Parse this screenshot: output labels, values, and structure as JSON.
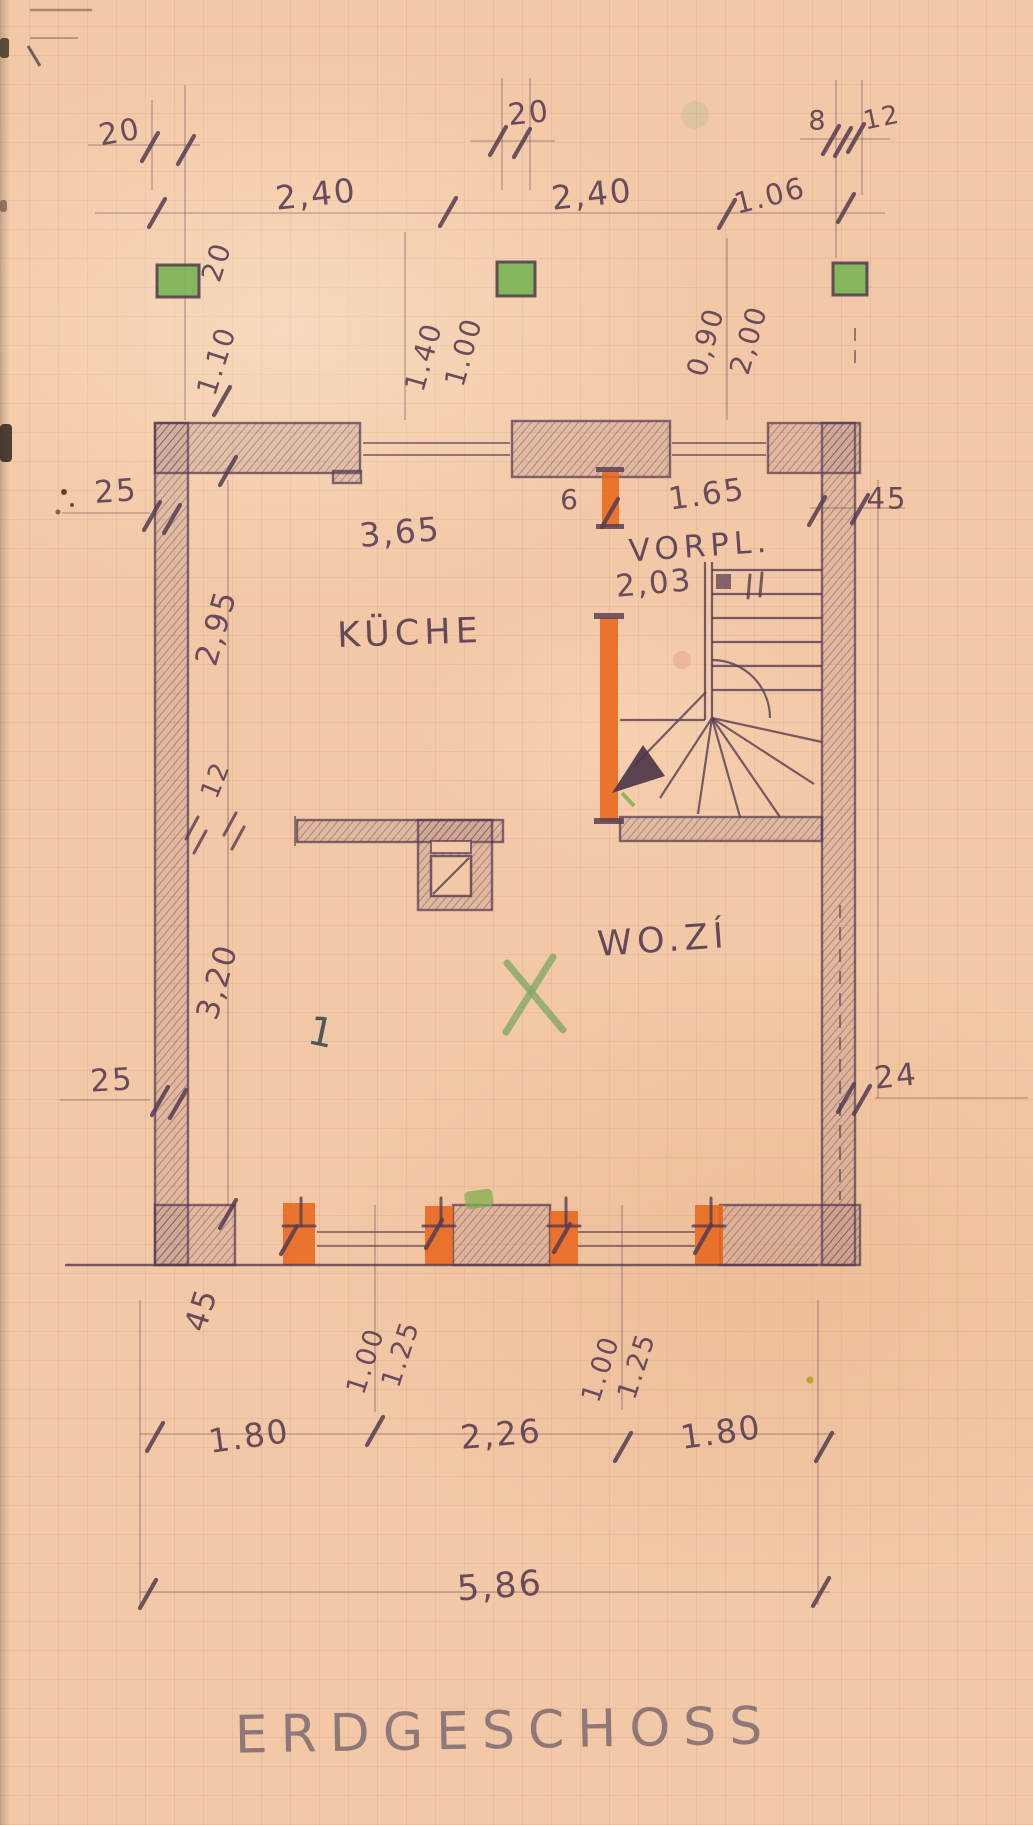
{
  "palette": {
    "paper": "#f3c8a6",
    "pencil": "#553c52",
    "pencil-light": "#7e6b72",
    "orange": "#e8661c",
    "green": "#79b454",
    "green-x": "#85a869",
    "pen": "#3c4e56"
  },
  "drawing": {
    "title": "ERDGESCHOSS",
    "type": "hand-drawn floor plan",
    "rooms_shown": [
      "KÜCHE",
      "VORPL.",
      "WO.ZÍ"
    ]
  },
  "annotations": {
    "dimensions": [
      {
        "name": "dim-20-top-left",
        "text": "20",
        "x": 120,
        "y": 133,
        "rot": -10,
        "size": 30
      },
      {
        "name": "dim-240-top-left",
        "text": "2,40",
        "x": 316,
        "y": 194,
        "rot": -6,
        "size": 33
      },
      {
        "name": "dim-20-top-mid",
        "text": "20",
        "x": 529,
        "y": 114,
        "rot": -6,
        "size": 30
      },
      {
        "name": "dim-240-top-right",
        "text": "2,40",
        "x": 592,
        "y": 194,
        "rot": -6,
        "size": 33
      },
      {
        "name": "dim-106-top",
        "text": "1.06",
        "x": 770,
        "y": 196,
        "rot": -14,
        "size": 29
      },
      {
        "name": "dim-8-top",
        "text": "8",
        "x": 818,
        "y": 121,
        "rot": 0,
        "size": 27
      },
      {
        "name": "dim-12-top",
        "text": "12",
        "x": 882,
        "y": 118,
        "rot": -12,
        "size": 26
      },
      {
        "name": "dim-20-upper-left-vert",
        "text": "20",
        "x": 217,
        "y": 262,
        "rot": -72,
        "size": 28
      },
      {
        "name": "dim-110-left-vert",
        "text": "1.10",
        "x": 217,
        "y": 361,
        "rot": -72,
        "size": 28
      },
      {
        "name": "dim-140-top-vert",
        "text": "1.40",
        "x": 424,
        "y": 357,
        "rot": -74,
        "size": 28
      },
      {
        "name": "dim-100-top-vert",
        "text": "1.00",
        "x": 464,
        "y": 352,
        "rot": -74,
        "size": 28
      },
      {
        "name": "dim-090-top-vert",
        "text": "0,90",
        "x": 706,
        "y": 342,
        "rot": -74,
        "size": 28
      },
      {
        "name": "dim-200-top-vert",
        "text": "2,00",
        "x": 749,
        "y": 340,
        "rot": -74,
        "size": 28
      },
      {
        "name": "dim-25-upper-left",
        "text": "25",
        "x": 116,
        "y": 492,
        "rot": -4,
        "size": 31
      },
      {
        "name": "dim-365-kueche",
        "text": "3,65",
        "x": 400,
        "y": 532,
        "rot": -5,
        "size": 33
      },
      {
        "name": "dim-6-door",
        "text": "6",
        "x": 570,
        "y": 500,
        "rot": 0,
        "size": 28
      },
      {
        "name": "dim-165-vorplatz",
        "text": "1.65",
        "x": 707,
        "y": 495,
        "rot": -8,
        "size": 31
      },
      {
        "name": "dim-45-upper-right",
        "text": "45",
        "x": 887,
        "y": 499,
        "rot": 0,
        "size": 29
      },
      {
        "name": "dim-295-left-vert",
        "text": "2,95",
        "x": 217,
        "y": 628,
        "rot": -74,
        "size": 31
      },
      {
        "name": "dim-12-left-vert",
        "text": "12",
        "x": 216,
        "y": 780,
        "rot": -68,
        "size": 26
      },
      {
        "name": "dim-320-left-vert",
        "text": "3,20",
        "x": 218,
        "y": 982,
        "rot": -74,
        "size": 31
      },
      {
        "name": "dim-25-lower-left",
        "text": "25",
        "x": 112,
        "y": 1081,
        "rot": -3,
        "size": 31
      },
      {
        "name": "dim-24-lower-right",
        "text": "24",
        "x": 896,
        "y": 1077,
        "rot": -6,
        "size": 31
      },
      {
        "name": "dim-45-lower-left-vert",
        "text": "45",
        "x": 202,
        "y": 1310,
        "rot": -72,
        "size": 31
      },
      {
        "name": "dim-100-bottom-left-vert",
        "text": "1.00",
        "x": 366,
        "y": 1361,
        "rot": -72,
        "size": 27
      },
      {
        "name": "dim-125-bottom-left-vert",
        "text": "1.25",
        "x": 401,
        "y": 1354,
        "rot": -72,
        "size": 27
      },
      {
        "name": "dim-100-bottom-right-vert",
        "text": "1.00",
        "x": 601,
        "y": 1369,
        "rot": -72,
        "size": 27
      },
      {
        "name": "dim-125-bottom-right-vert",
        "text": "1.25",
        "x": 637,
        "y": 1366,
        "rot": -72,
        "size": 27
      },
      {
        "name": "dim-180-bottom-left",
        "text": "1.80",
        "x": 249,
        "y": 1436,
        "rot": -8,
        "size": 33
      },
      {
        "name": "dim-226-bottom",
        "text": "2,26",
        "x": 501,
        "y": 1434,
        "rot": -5,
        "size": 33
      },
      {
        "name": "dim-180-bottom-right",
        "text": "1.80",
        "x": 721,
        "y": 1432,
        "rot": -8,
        "size": 33
      },
      {
        "name": "dim-586-bottom",
        "text": "5,86",
        "x": 500,
        "y": 1587,
        "rot": -4,
        "size": 35
      }
    ],
    "rooms": [
      {
        "name": "room-label-kueche",
        "text": "KÜCHE",
        "x": 410,
        "y": 634,
        "rot": -2,
        "size": 35,
        "cls": "room"
      },
      {
        "name": "room-label-vorplatz",
        "text": "VORPL.",
        "x": 700,
        "y": 547,
        "rot": -4,
        "size": 31,
        "cls": "room"
      },
      {
        "name": "room-label-wohnzimmer",
        "text": "WO.ZÍ",
        "x": 663,
        "y": 941,
        "rot": -4,
        "size": 35,
        "cls": "room"
      }
    ],
    "areas": [
      {
        "name": "area-vorplatz",
        "text": "2,03",
        "x": 654,
        "y": 584,
        "rot": -5,
        "size": 31
      }
    ],
    "marks": [
      {
        "name": "pen-mark-1",
        "text": "1",
        "x": 322,
        "y": 1033,
        "rot": 12,
        "size": 40,
        "cls": "pen"
      }
    ],
    "title": [
      {
        "name": "plan-title-erdgeschoss",
        "text": "ERDGESCHOSS",
        "x": 505,
        "y": 1731,
        "rot": -1,
        "size": 52,
        "cls": "title"
      }
    ]
  }
}
